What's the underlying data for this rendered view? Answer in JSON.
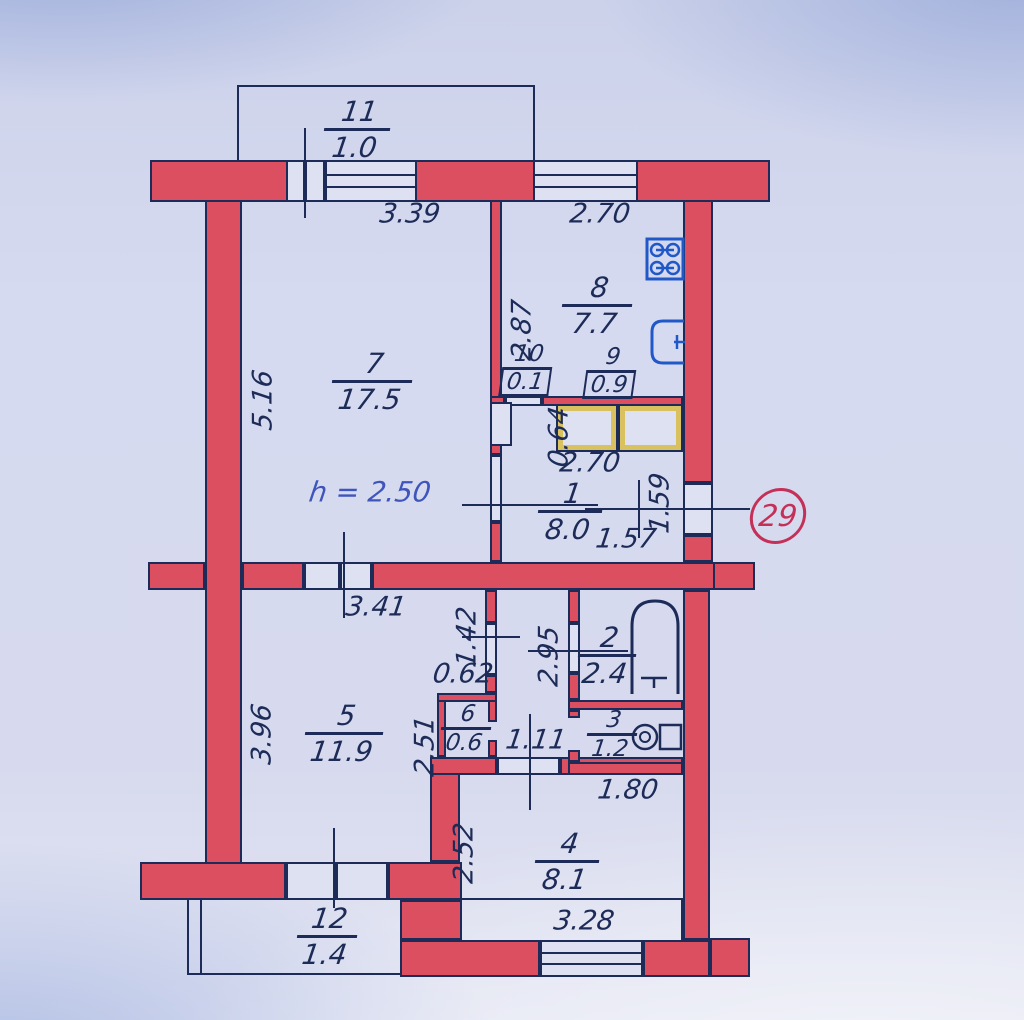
{
  "unit": {
    "number": "29"
  },
  "note": {
    "ceiling_height": "h = 2.50"
  },
  "rooms": {
    "r1": {
      "number": "1",
      "area": "8.0"
    },
    "r2": {
      "number": "2",
      "area": "2.4"
    },
    "r3": {
      "number": "3",
      "area": "1.2"
    },
    "r4": {
      "number": "4",
      "area": "8.1"
    },
    "r5": {
      "number": "5",
      "area": "11.9"
    },
    "r6": {
      "number": "6",
      "area": "0.6"
    },
    "r7": {
      "number": "7",
      "area": "17.5"
    },
    "r8": {
      "number": "8",
      "area": "7.7"
    },
    "r9": {
      "number": "9",
      "area": "0.9"
    },
    "r10": {
      "number": "10",
      "area": "0.1"
    },
    "r11": {
      "number": "11",
      "area": "1.0"
    },
    "r12": {
      "number": "12",
      "area": "1.4"
    }
  },
  "dims": {
    "balcony11_width": "3.39",
    "kitchen_width": "2.70",
    "room7_depth": "5.16",
    "kitchen_depth": "2.87",
    "closet_depth": "0.64",
    "hall_width": "2.70",
    "hall_right_width": "1.57",
    "entry_depth": "1.59",
    "room5_width": "3.41",
    "nook_depth": "1.42",
    "nook_width": "0.62",
    "bath_depth": "2.95",
    "room5_depth": "3.96",
    "corridor_depth": "2.51",
    "corridor_width": "1.11",
    "toilet_width": "1.80",
    "room4_depth": "2.52",
    "room4_width": "3.28"
  },
  "icons": {
    "stove": "stove-icon",
    "sink": "sink-icon",
    "bathtub": "bathtub-icon",
    "toilet": "toilet-icon"
  },
  "colors": {
    "wall": "#dc4f60",
    "line": "#1c2b57",
    "fixture_blue": "#2158c8",
    "accent_red": "#c43057",
    "closet_yellow": "#d9c160",
    "paper": "#d6daee"
  }
}
